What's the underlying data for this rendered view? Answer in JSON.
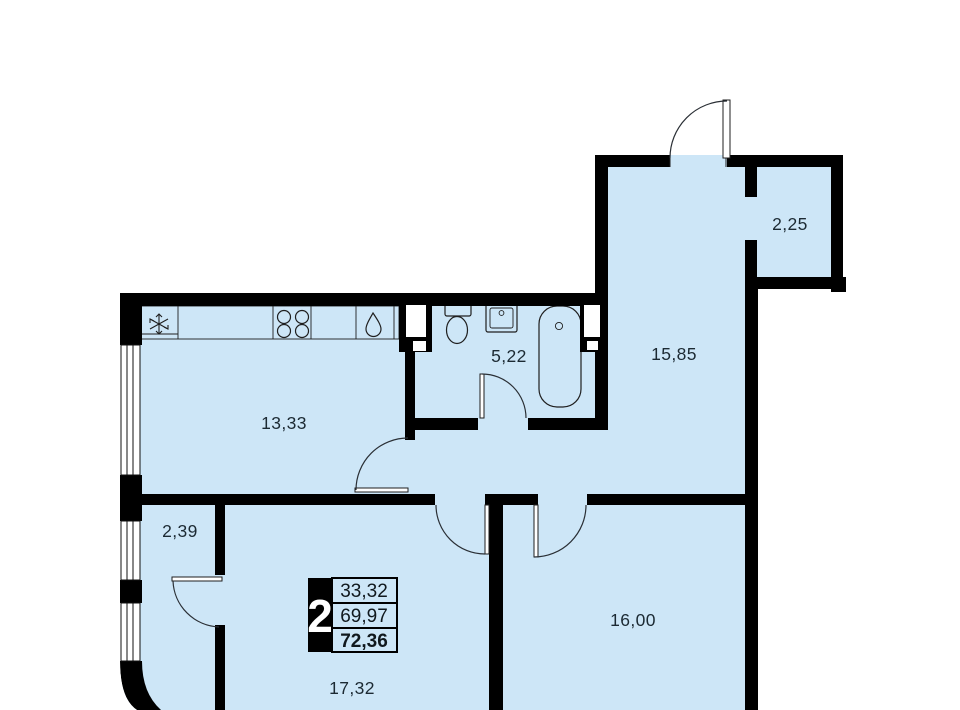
{
  "floorplan": {
    "unit_info": {
      "rooms_count": "2",
      "living_area": "33,32",
      "area_without_balcony": "69,97",
      "total_area": "72,36"
    },
    "room_areas": {
      "kitchen_living": "13,33",
      "bathroom": "5,22",
      "hallway": "15,85",
      "balcony": "2,25",
      "wardrobe": "2,39",
      "bedroom": "16,00",
      "living_room": "17,32"
    },
    "colors": {
      "floor_fill": "#cde6f7",
      "wall": "#000000",
      "label_text": "#1c2a33"
    }
  }
}
